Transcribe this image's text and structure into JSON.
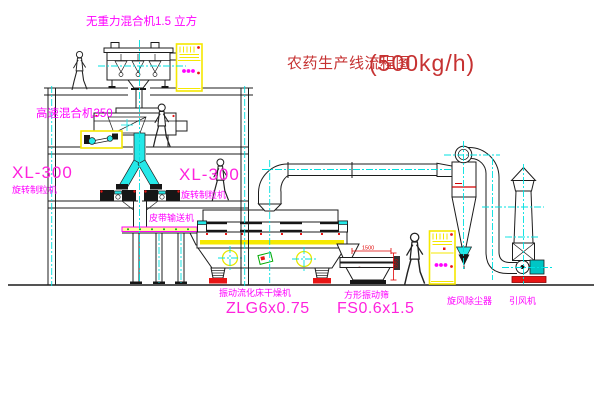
{
  "title": {
    "name": "农药生产线流程图",
    "capacity": "(500kg/h)"
  },
  "labels": {
    "gravity_mixer": "无重力混合机1.5 立方",
    "high_speed_mixer": "高速混合机350",
    "granulator_model_left": "XL-300",
    "granulator_name_left": "旋转制粒机",
    "granulator_model_right": "XL-300",
    "granulator_name_right": "旋转制粒机",
    "belt_conveyor": "皮带输送机",
    "dryer_name": "振动流化床干燥机",
    "dryer_model": "ZLG6x0.75",
    "screen_name": "方形振动筛",
    "screen_model": "FS0.6x1.5",
    "cyclone_name": "旋风除尘器",
    "fan_name": "引风机"
  },
  "dimensions": {
    "screen_length": "1500",
    "screen_height": "595"
  },
  "colors": {
    "label_magenta": "#FF00FF",
    "title_red": "#C63232",
    "centerline_cyan": "#00E0E0",
    "cabinet_yellow": "#F5E800",
    "accent_red": "#E81515",
    "belt_green": "#00AA00",
    "linework": "#1C1C1C"
  }
}
